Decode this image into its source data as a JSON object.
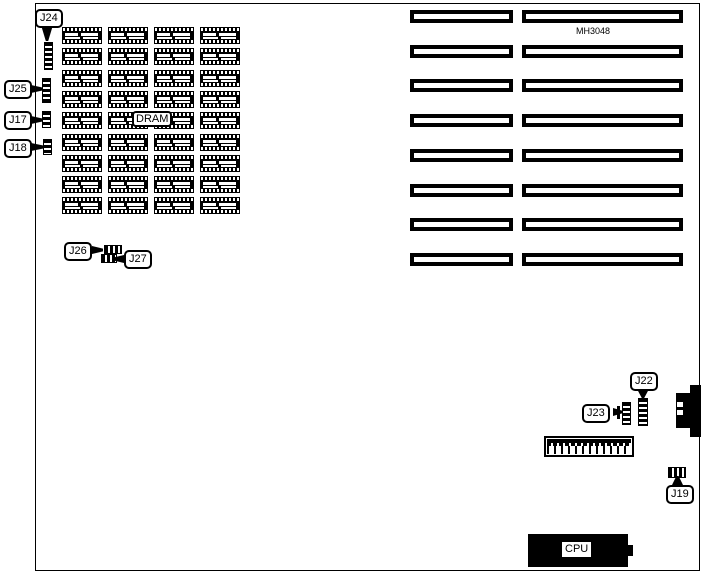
{
  "labels": {
    "j24": "J24",
    "j25": "J25",
    "j17": "J17",
    "j18": "J18",
    "j26": "J26",
    "j27": "J27",
    "j22": "J22",
    "j23": "J23",
    "j19": "J19",
    "dram": "DRAM",
    "cpu": "CPU",
    "model": "MH3048"
  },
  "dram_grid": {
    "rows": 9,
    "columns": 4
  },
  "slots": {
    "rows": 8,
    "columns": 2
  },
  "colors": {
    "background": "#ffffff",
    "component": "#000000"
  }
}
